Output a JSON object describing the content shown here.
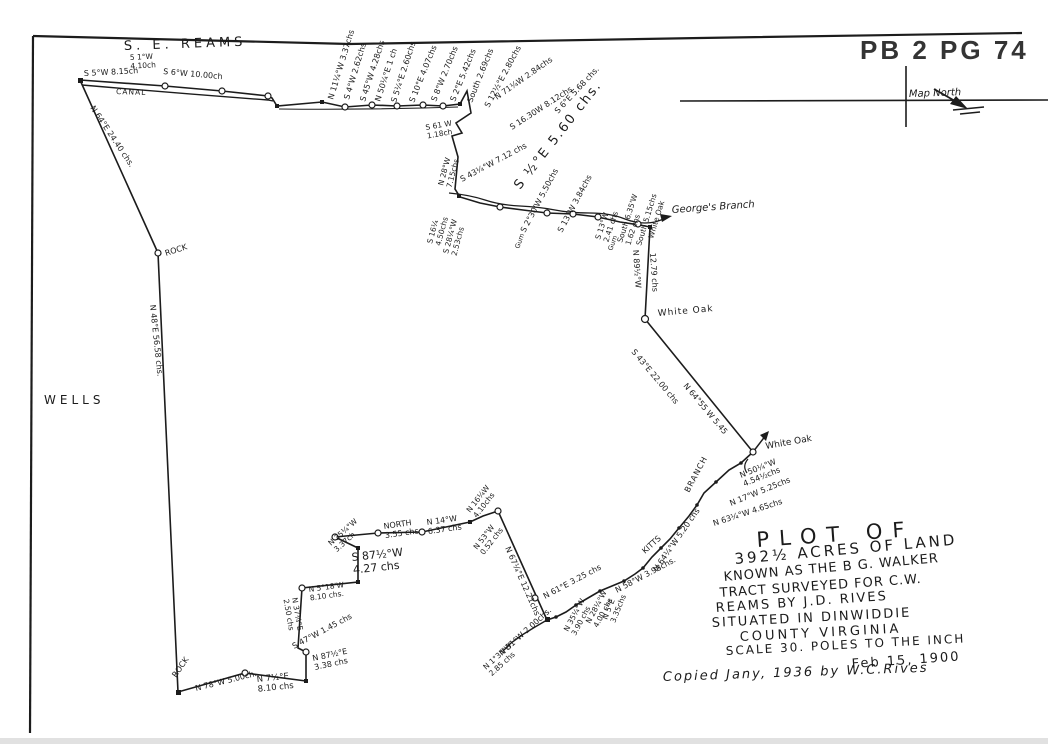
{
  "header": {
    "plat_ref": "PB 2 PG 74"
  },
  "compass": {
    "label": "Map North"
  },
  "notes": {
    "copied": "Copied Jany, 1936 by W.C.Rives"
  },
  "title_block": {
    "lines": [
      {
        "t": "PLOT OF",
        "x": 757,
        "y": 547,
        "r": -4,
        "s": 21,
        "ls": 10
      },
      {
        "t": "392½ ACRES OF LAND",
        "x": 735,
        "y": 564,
        "r": -5,
        "s": 15,
        "ls": 3
      },
      {
        "t": "KNOWN AS THE B G. WALKER",
        "x": 724,
        "y": 581,
        "r": -5,
        "s": 13,
        "ls": 1
      },
      {
        "t": "TRACT SURVEYED FOR C.W.",
        "x": 720,
        "y": 597,
        "r": -4,
        "s": 13,
        "ls": 1
      },
      {
        "t": "REAMS BY J.D. RIVES",
        "x": 716,
        "y": 612,
        "r": -4,
        "s": 13,
        "ls": 2
      },
      {
        "t": "SITUATED IN DINWIDDIE",
        "x": 712,
        "y": 627,
        "r": -3,
        "s": 13,
        "ls": 2
      },
      {
        "t": "COUNTY VIRGINIA",
        "x": 740,
        "y": 641,
        "r": -3,
        "s": 13,
        "ls": 3
      },
      {
        "t": "SCALE 30. POLES TO THE INCH",
        "x": 726,
        "y": 655,
        "r": -3,
        "s": 12,
        "ls": 2
      },
      {
        "t": "Feb 15, 1900",
        "x": 852,
        "y": 668,
        "r": -4,
        "s": 13,
        "ls": 2
      }
    ]
  },
  "place_labels": [
    {
      "t": "S. E. REAMS",
      "x": 124,
      "y": 50,
      "r": -2,
      "s": 13,
      "ls": 4
    },
    {
      "t": "CANAL",
      "x": 116,
      "y": 94,
      "r": 2,
      "s": 7.5,
      "ls": 1
    },
    {
      "t": "WELLS",
      "x": 44,
      "y": 404,
      "r": 0,
      "s": 12,
      "ls": 4
    },
    {
      "t": "ROCK",
      "x": 166,
      "y": 256,
      "r": -18,
      "s": 8
    },
    {
      "t": "ROCK",
      "x": 176,
      "y": 678,
      "r": -55,
      "s": 8
    },
    {
      "t": "White Oak",
      "x": 658,
      "y": 316,
      "r": -5,
      "s": 9,
      "ls": 1
    },
    {
      "t": "White Oak",
      "x": 766,
      "y": 449,
      "r": -10,
      "s": 9
    },
    {
      "t": "George's Branch",
      "x": 672,
      "y": 213,
      "r": -4,
      "s": 10,
      "it": 1
    },
    {
      "t": "KITTS",
      "x": 645,
      "y": 554,
      "r": -42,
      "s": 8
    },
    {
      "t": "BRANCH",
      "x": 689,
      "y": 493,
      "r": -62,
      "s": 8,
      "ls": 1
    }
  ],
  "bearing_annotations": [
    {
      "t": "S 5°W 8.15ch",
      "x": 84,
      "y": 76,
      "r": -3
    },
    {
      "t": "5 1°W\n4.10ch",
      "x": 130,
      "y": 60,
      "r": -3,
      "s": 7.5
    },
    {
      "t": "S 6°W 10.00ch",
      "x": 163,
      "y": 74,
      "r": 5
    },
    {
      "t": "N 64°E 24.40 chs.",
      "x": 90,
      "y": 108,
      "r": 56
    },
    {
      "t": "N 48°E 56.58 chs.",
      "x": 150,
      "y": 305,
      "r": 84
    },
    {
      "t": "N 11¼°W 3.37chs",
      "x": 333,
      "y": 100,
      "r": -73
    },
    {
      "t": "S 4°W 2.62chs",
      "x": 349,
      "y": 100,
      "r": -73
    },
    {
      "t": "S 45°W 4.28chs",
      "x": 365,
      "y": 102,
      "r": -72
    },
    {
      "t": "N 50¼°E 1 ch",
      "x": 380,
      "y": 102,
      "r": -72
    },
    {
      "t": "S 5¼°E 2.60chs",
      "x": 396,
      "y": 103,
      "r": -72
    },
    {
      "t": "S 10°E 4.07chs",
      "x": 414,
      "y": 103,
      "r": -68
    },
    {
      "t": "S 8°W 2.70chs",
      "x": 436,
      "y": 102,
      "r": -68
    },
    {
      "t": "S 2°E 5.42chs",
      "x": 455,
      "y": 102,
      "r": -68
    },
    {
      "t": "South 2.69chs",
      "x": 472,
      "y": 103,
      "r": -68
    },
    {
      "t": "S 12½°E 2.80chs",
      "x": 489,
      "y": 108,
      "r": -62
    },
    {
      "t": "N 71¼W 2.84chs",
      "x": 497,
      "y": 100,
      "r": -35
    },
    {
      "t": "S 16.30W 8.12chs.",
      "x": 512,
      "y": 130,
      "r": -33
    },
    {
      "t": "S 6°E 5.68 chs.",
      "x": 558,
      "y": 114,
      "r": -47
    },
    {
      "t": "S 61 W\n1.18ch",
      "x": 426,
      "y": 130,
      "r": -10,
      "s": 7.5
    },
    {
      "t": "N 28°W\n7.15chs",
      "x": 443,
      "y": 186,
      "r": -75,
      "s": 7.5
    },
    {
      "t": "S 43¼°W 7.12 chs",
      "x": 462,
      "y": 182,
      "r": -28
    },
    {
      "t": "S ½°E 5.60 chs.",
      "x": 520,
      "y": 190,
      "r": -52,
      "s": 13,
      "ls": 2
    },
    {
      "t": "S 16¼\n4.50chs",
      "x": 432,
      "y": 244,
      "r": -75,
      "s": 7.5
    },
    {
      "t": "S 28¼°W\n2.53chs",
      "x": 448,
      "y": 254,
      "r": -75,
      "s": 7.5
    },
    {
      "t": "S 2°30'W 5.50chs",
      "x": 525,
      "y": 233,
      "r": -62
    },
    {
      "t": "S 13°W 3.84chs",
      "x": 562,
      "y": 233,
      "r": -62
    },
    {
      "t": "S 13°W\n2.41 chs",
      "x": 600,
      "y": 240,
      "r": -72,
      "s": 7.5
    },
    {
      "t": "South 6.35'W\n1.62 chs",
      "x": 622,
      "y": 243,
      "r": -72,
      "s": 7.5
    },
    {
      "t": "South 5.15chs",
      "x": 641,
      "y": 246,
      "r": -73,
      "s": 7.5
    },
    {
      "t": "White Oak",
      "x": 653,
      "y": 239,
      "r": -73,
      "s": 7.5
    },
    {
      "t": "Gum",
      "x": 519,
      "y": 249,
      "r": -70,
      "s": 6.5
    },
    {
      "t": "Gum",
      "x": 612,
      "y": 251,
      "r": -70,
      "s": 6.5
    },
    {
      "t": "N 89½°W",
      "x": 633,
      "y": 250,
      "r": 86
    },
    {
      "t": "12.79 chs",
      "x": 650,
      "y": 253,
      "r": 86
    },
    {
      "t": "S 43°E 22.00 chs",
      "x": 631,
      "y": 352,
      "r": 50
    },
    {
      "t": "N 64°55 W 5.45",
      "x": 683,
      "y": 386,
      "r": 50
    },
    {
      "t": "N 50¼°W\n4.54½chs",
      "x": 741,
      "y": 478,
      "r": -22
    },
    {
      "t": "N 17°W 5.25chs",
      "x": 731,
      "y": 506,
      "r": -22
    },
    {
      "t": "N 63¼°W 4.65chs",
      "x": 714,
      "y": 526,
      "r": -18
    },
    {
      "t": "N 64¼°W 5.20 chs",
      "x": 657,
      "y": 572,
      "r": -55
    },
    {
      "t": "N 58°W 3.98chs.",
      "x": 617,
      "y": 593,
      "r": -28
    },
    {
      "t": "N 5°E\n3.35chs",
      "x": 607,
      "y": 620,
      "r": -68,
      "s": 7.5
    },
    {
      "t": "N 28¼°W\n4.00 chs",
      "x": 590,
      "y": 624,
      "r": -62,
      "s": 7.5
    },
    {
      "t": "N 35¼°W\n3.90 chs",
      "x": 568,
      "y": 632,
      "r": -62,
      "s": 7.5
    },
    {
      "t": "N 61°E 3.25 chs",
      "x": 545,
      "y": 599,
      "r": -28
    },
    {
      "t": "N 31°W 2.00chs.",
      "x": 502,
      "y": 656,
      "r": -42
    },
    {
      "t": "N 1°34'W\n2.85 chs",
      "x": 486,
      "y": 670,
      "r": -42,
      "s": 7.5
    },
    {
      "t": "N 67¼°E 12.21chs",
      "x": 505,
      "y": 548,
      "r": 66
    },
    {
      "t": "N 53°W\n0.52 chs",
      "x": 477,
      "y": 550,
      "r": -52,
      "s": 7.5
    },
    {
      "t": "N 16¼W\n4.10chs",
      "x": 470,
      "y": 513,
      "r": -52,
      "s": 7.5
    },
    {
      "t": "N 14°W\n6.37 chs",
      "x": 427,
      "y": 525,
      "r": -8
    },
    {
      "t": "NORTH\n3.55 chs",
      "x": 384,
      "y": 529,
      "r": -8
    },
    {
      "t": "N 35¼°W\n3.37ch",
      "x": 331,
      "y": 546,
      "r": -42,
      "s": 7.5
    },
    {
      "t": "S 87½°W\n4.27 chs",
      "x": 352,
      "y": 561,
      "r": -6,
      "s": 11
    },
    {
      "t": "N 5°18'W\n8.10 chs.",
      "x": 309,
      "y": 592,
      "r": -8,
      "s": 7.5
    },
    {
      "t": "N 37¼°E\n2.50 chs",
      "x": 292,
      "y": 598,
      "r": 80,
      "s": 7.5
    },
    {
      "t": "S 47°W 1.45 chs",
      "x": 294,
      "y": 649,
      "r": -28
    },
    {
      "t": "N 87½°E\n3.38 chs",
      "x": 313,
      "y": 661,
      "r": -12
    },
    {
      "t": "N 7½°E\n8.10 chs",
      "x": 257,
      "y": 682,
      "r": -6,
      "s": 8.5
    },
    {
      "t": "N 78°W 5.00ch.",
      "x": 196,
      "y": 691,
      "r": -14
    }
  ]
}
